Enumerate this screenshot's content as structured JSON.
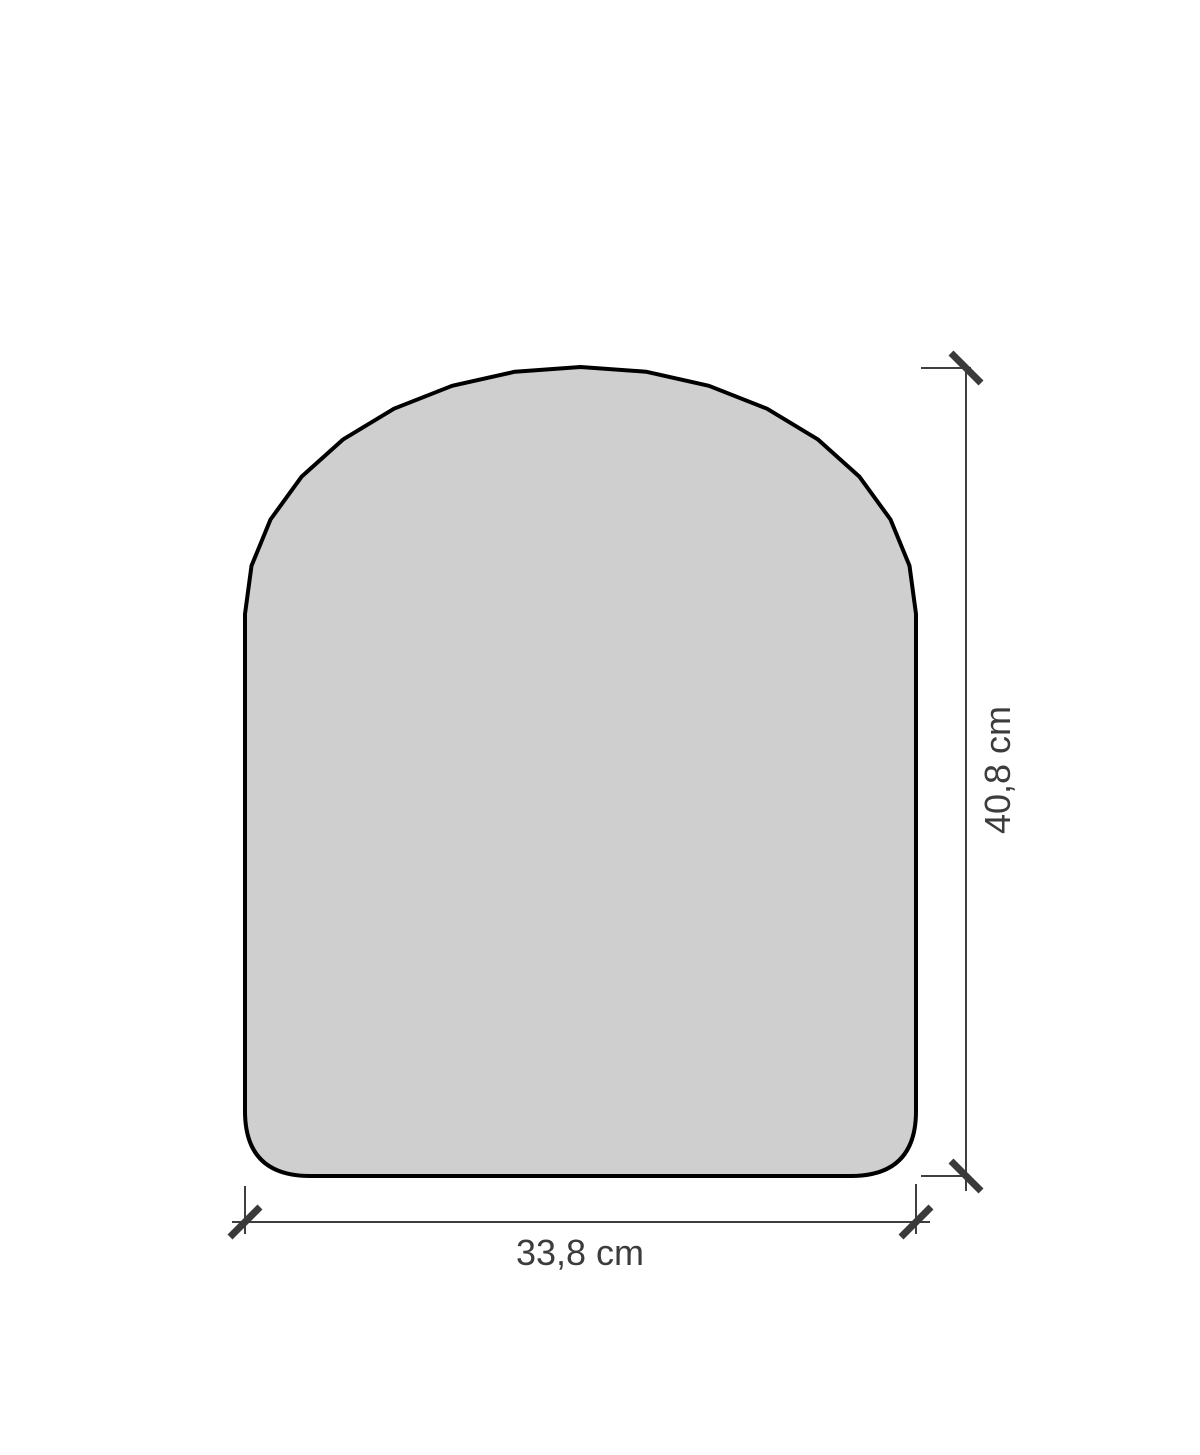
{
  "drawing": {
    "subject": "panel-outline-with-dimensions",
    "dimensions": {
      "height": {
        "label": "40,8 cm",
        "value": "40,8",
        "unit": "cm",
        "orientation": "vertical"
      },
      "width": {
        "label": "33,8 cm",
        "value": "33,8",
        "unit": "cm",
        "orientation": "horizontal"
      }
    },
    "colors": {
      "panel_fill": "#cfcfcf",
      "panel_outline": "#000000",
      "dimension_line": "#3f3f3f",
      "dimension_tick": "#3a3a3a",
      "dimension_text": "#3c3c3c",
      "background": "#ffffff"
    }
  }
}
